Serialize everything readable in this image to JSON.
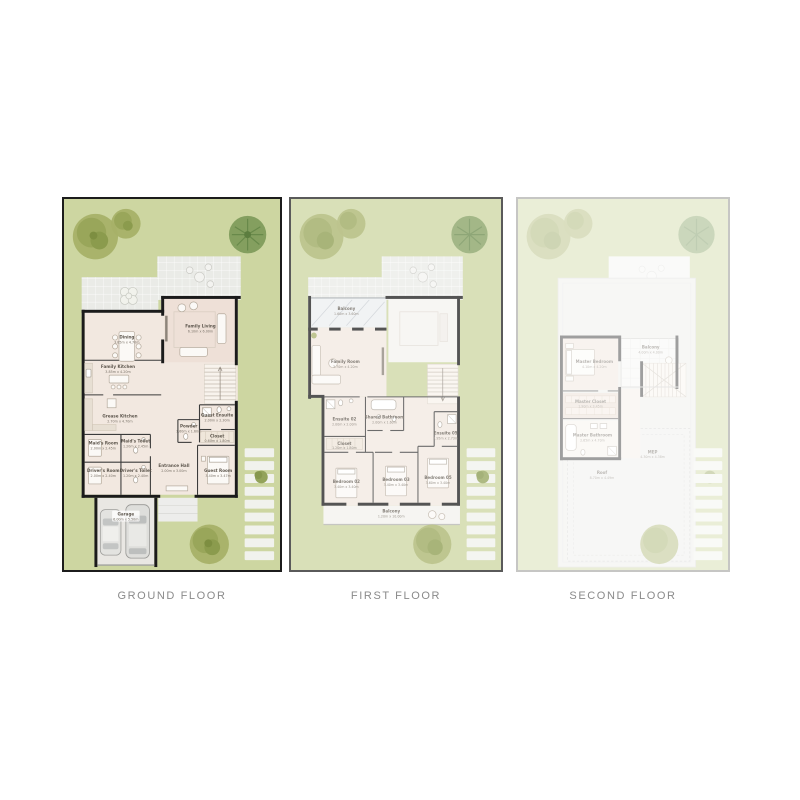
{
  "palette": {
    "garden_green": "#cdd6a1",
    "patio_gray": "#eaebe7",
    "floor_beige": "#f2e8e0",
    "wall_black": "#1b1b1b",
    "tree_olive": "#a7b168",
    "tree_dark": "#7f9c5c",
    "caption_text": "#8a8a8a"
  },
  "plans": {
    "ground": {
      "caption": "GROUND FLOOR",
      "rooms": {
        "dining": {
          "name": "Dining",
          "dims": "3.85m x 4.70m"
        },
        "family_living": {
          "name": "Family Living",
          "dims": "6.10m x 6.00m"
        },
        "family_kitchen": {
          "name": "Family Kitchen",
          "dims": "3.85m x 4.20m"
        },
        "grease_kitchen": {
          "name": "Grease Kitchen",
          "dims": "2.70m x 4.70m"
        },
        "maids_room": {
          "name": "Maid's Room",
          "dims": "2.00m x 2.45m"
        },
        "maids_toilet": {
          "name": "Maid's Toilet",
          "dims": "1.20m x 2.45m"
        },
        "drivers_room": {
          "name": "Driver's Room",
          "dims": "2.00m x 2.40m"
        },
        "drivers_toilet": {
          "name": "Driver's Toilet",
          "dims": "1.20m x 2.40m"
        },
        "entrance_hall": {
          "name": "Entrance Hall",
          "dims": "2.00m x 3.00m"
        },
        "powder": {
          "name": "Powder",
          "dims": "1.60m x 1.60m"
        },
        "guest_ensuite": {
          "name": "Guest Ensuite",
          "dims": "2.00m x 2.30m"
        },
        "closet": {
          "name": "Closet",
          "dims": "0.60m x 1.80m"
        },
        "guest_room": {
          "name": "Guest Room",
          "dims": "3.40m x 3.47m"
        },
        "garage": {
          "name": "Garage",
          "dims": "6.00m x 5.50m"
        }
      }
    },
    "first": {
      "caption": "FIRST FLOOR",
      "rooms": {
        "balcony_top": {
          "name": "Balcony",
          "dims": "1.60m x 3.60m"
        },
        "family_room": {
          "name": "Family Room",
          "dims": "3.70m x 4.20m"
        },
        "ensuite_02": {
          "name": "Ensuite 02",
          "dims": "2.00m x 2.00m"
        },
        "shared_bathroom": {
          "name": "Shared Bathroom",
          "dims": "2.00m x 1.60m"
        },
        "ensuite_05": {
          "name": "Ensuite 05",
          "dims": "1.95m x 2.73m"
        },
        "closet": {
          "name": "Closet",
          "dims": "1.20m x 1.80m"
        },
        "bedroom_02": {
          "name": "Bedroom 02",
          "dims": "3.40m x 3.40m"
        },
        "bedroom_03": {
          "name": "Bedroom 03",
          "dims": "3.40m x 3.40m"
        },
        "bedroom_05": {
          "name": "Bedroom 05",
          "dims": "3.60m x 3.40m"
        },
        "balcony_bottom": {
          "name": "Balcony",
          "dims": "1.20m x 10.00m"
        }
      }
    },
    "second": {
      "caption": "SECOND FLOOR",
      "rooms": {
        "master_bedroom": {
          "name": "Master Bedroom",
          "dims": "4.10m x 4.20m"
        },
        "balcony": {
          "name": "Balcony",
          "dims": "4.00m x 4.00m"
        },
        "master_closet": {
          "name": "Master Closet",
          "dims": "1.90m x 3.45m"
        },
        "master_bathroom": {
          "name": "Master Bathroom",
          "dims": "2.65m x 4.70m"
        },
        "mep": {
          "name": "MEP",
          "dims": "4.30m x 4.38m"
        },
        "roof": {
          "name": "Roof",
          "dims": "8.70m x 4.49m"
        }
      }
    }
  }
}
